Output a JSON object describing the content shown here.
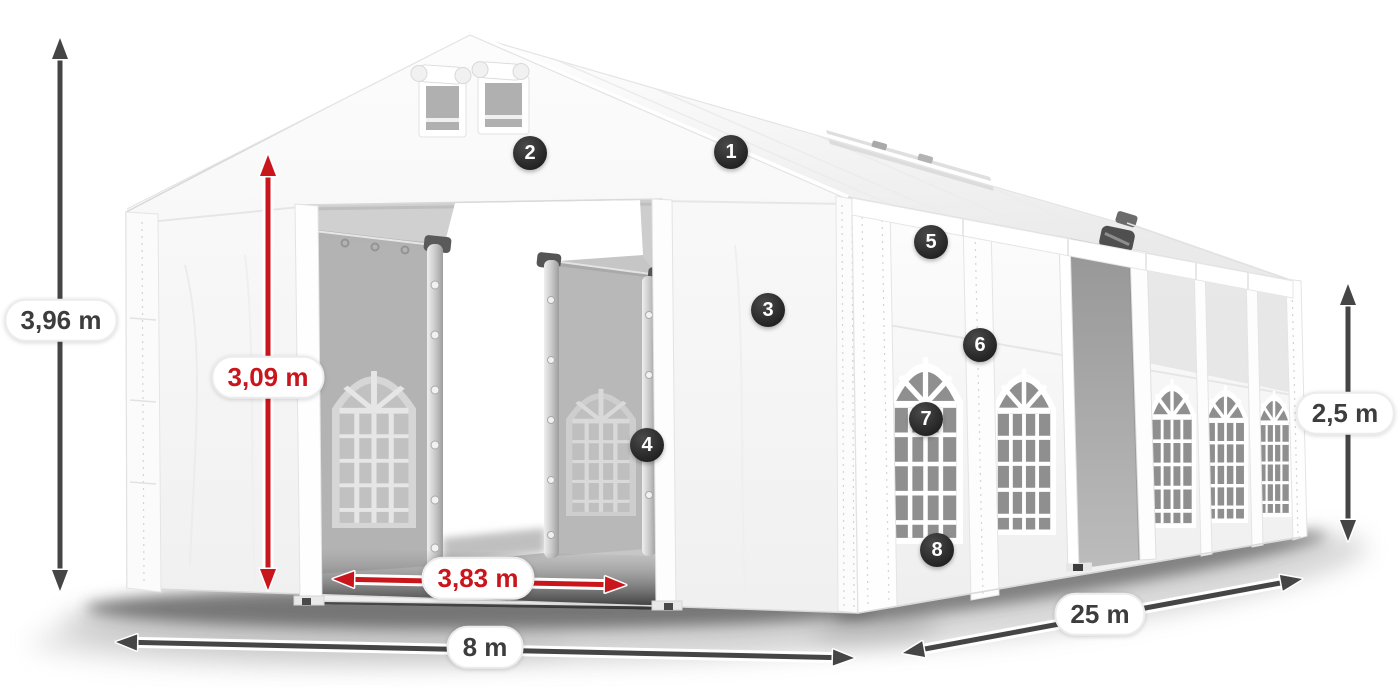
{
  "dimensions": {
    "total_height": {
      "label": "3,96 m",
      "style": "dark"
    },
    "entrance_height": {
      "label": "3,09 m",
      "style": "red"
    },
    "entrance_width": {
      "label": "3,83 m",
      "style": "red"
    },
    "front_width": {
      "label": "8 m",
      "style": "dark"
    },
    "side_length": {
      "label": "25 m",
      "style": "dark"
    },
    "side_height": {
      "label": "2,5 m",
      "style": "dark"
    }
  },
  "badges": [
    {
      "number": "1"
    },
    {
      "number": "2"
    },
    {
      "number": "3"
    },
    {
      "number": "4"
    },
    {
      "number": "5"
    },
    {
      "number": "6"
    },
    {
      "number": "7"
    },
    {
      "number": "8"
    }
  ],
  "colors": {
    "accent_red": "#c9161c",
    "arrow_dark": "#454545",
    "badge_background": "#2a2a2a",
    "badge_text": "#ffffff",
    "label_text": "#3d3d3d",
    "label_background": "#ffffff",
    "tent_white": "#f7f7f7",
    "interior_grey": "#c6c6c6"
  }
}
